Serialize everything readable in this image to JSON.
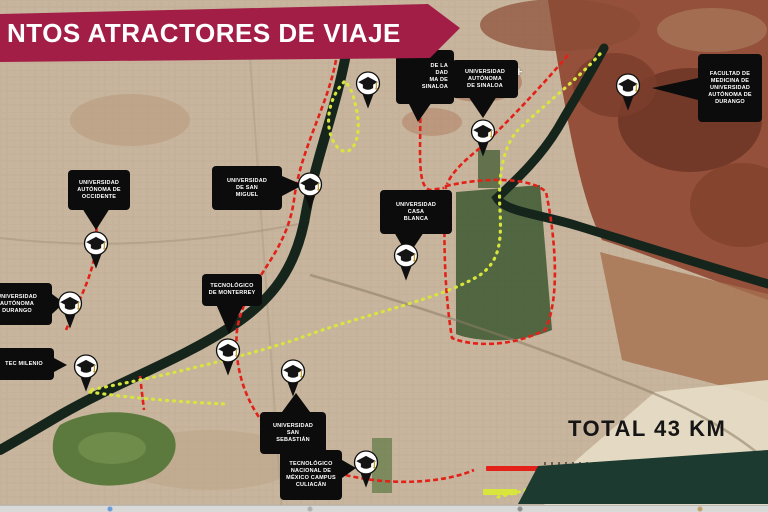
{
  "banner": {
    "title": "NTOS ATRACTORES DE VIAJE",
    "bg_color": "#a31e46"
  },
  "map": {
    "plus": {
      "glyph": "+",
      "x": 515,
      "y": 64
    },
    "markers": [
      {
        "id": "uas",
        "x": 483,
        "y": 131
      },
      {
        "id": "fac-medicina",
        "x": 628,
        "y": 85
      },
      {
        "id": "san-miguel",
        "x": 310,
        "y": 184
      },
      {
        "id": "casa-blanca",
        "x": 406,
        "y": 255
      },
      {
        "id": "occidente",
        "x": 96,
        "y": 243
      },
      {
        "id": "aut-durango",
        "x": 70,
        "y": 303
      },
      {
        "id": "tec-milenio",
        "x": 86,
        "y": 366
      },
      {
        "id": "tec-monterrey",
        "x": 228,
        "y": 350
      },
      {
        "id": "san-sebastian",
        "x": 293,
        "y": 371
      },
      {
        "id": "tecnm-culiacan",
        "x": 366,
        "y": 462
      },
      {
        "id": "sin-etiqueta",
        "x": 368,
        "y": 83
      }
    ],
    "labels": [
      {
        "id": "uas",
        "lines": [
          "UNIVERSIDAD",
          "AUTÓNOMA",
          "DE SINALOA"
        ],
        "box": [
          452,
          60,
          66,
          38
        ],
        "pointer": "468,96 497,96 483,118"
      },
      {
        "id": "uas-parcial",
        "lines": [
          "DE LA",
          "DAD",
          "MA DE",
          "SINALOA"
        ],
        "align": "right",
        "box": [
          396,
          50,
          58,
          54
        ],
        "pointer": "408,102 432,102 418,122"
      },
      {
        "id": "fac-medicina",
        "lines": [
          "FACULTAD DE",
          "MEDICINA DE",
          "UNIVERSIDAD",
          "AUTÓNOMA DE",
          "DURANGO"
        ],
        "box": [
          698,
          54,
          64,
          68
        ],
        "pointer": "698,78 698,100 652,88"
      },
      {
        "id": "occidente",
        "lines": [
          "UNIVERSIDAD",
          "AUTÓNOMA DE",
          "OCCIDENTE"
        ],
        "box": [
          68,
          170,
          62,
          40
        ],
        "pointer": "82,208 110,208 96,230"
      },
      {
        "id": "san-miguel",
        "lines": [
          "UNIVERSIDAD",
          "DE SAN",
          "MIGUEL"
        ],
        "box": [
          212,
          166,
          70,
          44
        ],
        "pointer": "282,176 282,196 303,185"
      },
      {
        "id": "casa-blanca",
        "lines": [
          "UNIVERSIDAD",
          "CASA",
          "BLANCA"
        ],
        "box": [
          380,
          190,
          72,
          44
        ],
        "pointer": "394,232 424,232 408,256"
      },
      {
        "id": "tec-monterrey",
        "lines": [
          "TECNOLÓGICO",
          "DE MONTERREY"
        ],
        "box": [
          202,
          274,
          60,
          32
        ],
        "pointer": "216,304 244,304 229,334"
      },
      {
        "id": "aut-durango",
        "lines": [
          "UNIVERSIDAD",
          "AUTÓNOMA",
          "DURANGO"
        ],
        "box": [
          -18,
          283,
          70,
          42
        ],
        "pointer": "52,294 52,314 64,303"
      },
      {
        "id": "tec-milenio",
        "lines": [
          "TEC MILENIO"
        ],
        "box": [
          -6,
          348,
          60,
          32
        ],
        "pointer": "54,358 54,372 67,365"
      },
      {
        "id": "san-sebastian",
        "lines": [
          "UNIVERSIDAD",
          "SAN",
          "SEBASTIÁN"
        ],
        "box": [
          260,
          412,
          66,
          42
        ],
        "pointer": "282,412 310,412 296,393"
      },
      {
        "id": "tecnm-culiacan",
        "lines": [
          "TECNOLÓGICO",
          "NACIONAL DE",
          "MÉXICO CAMPUS",
          "CULIACÁN"
        ],
        "box": [
          280,
          450,
          62,
          50
        ],
        "pointer": "342,460 342,478 356,468"
      }
    ]
  },
  "legend": {
    "total_label": "TOTAL 43 KM",
    "items": [
      {
        "swatch_color": "#e32119",
        "box": [
          486,
          466,
          58,
          5
        ]
      },
      {
        "swatch_color": "#d8e53c",
        "box": [
          483,
          489,
          34,
          6
        ]
      }
    ],
    "note_text_obscured": true
  },
  "colors": {
    "banner": "#a31e46",
    "label_bg": "#0c0c0c",
    "route_red": "#e32119",
    "route_yellow": "#d8e53c",
    "river": "#16251c",
    "overlay_green": "#1d3a30",
    "terrain_urban": "#c8b59d",
    "terrain_rural": "#94503a"
  }
}
